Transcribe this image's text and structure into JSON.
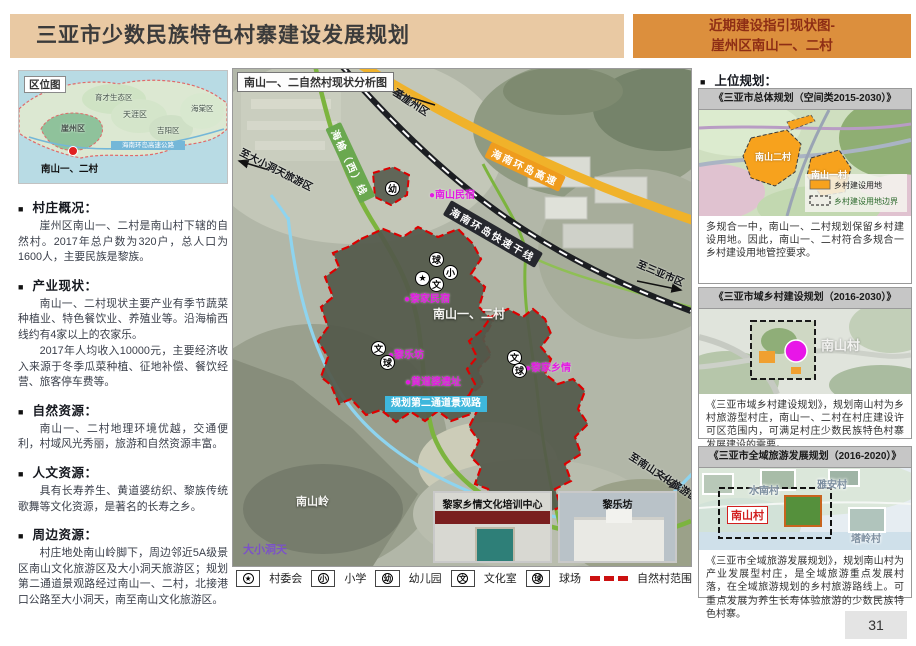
{
  "bullet": "■",
  "header": {
    "title": "三亚市少数民族特色村寨建设发展规划",
    "tag_line1": "近期建设指引现状图-",
    "tag_line2": "崖州区南山一、二村"
  },
  "location_map": {
    "label": "区位图",
    "districts": [
      "育才生态区",
      "崖州区",
      "天涯区",
      "吉阳区",
      "海棠区"
    ],
    "highway": "海南环岛高速公路",
    "marker": "南山一、二村"
  },
  "sections": [
    {
      "title": "村庄概况：",
      "paragraphs": [
        "崖州区南山一、二村是南山村下辖的自然村。2017年总户数为320户，总人口为1600人，主要民族是黎族。"
      ]
    },
    {
      "title": "产业现状：",
      "paragraphs": [
        "南山一、二村现状主要产业有季节蔬菜种植业、特色餐饮业、养殖业等。沿海榆西线约有4家以上的农家乐。",
        "2017年人均收入10000元，主要经济收入来源于冬季瓜菜种植、征地补偿、餐饮经营、旅客停车费等。"
      ]
    },
    {
      "title": "自然资源：",
      "paragraphs": [
        "南山一、二村地理环境优越，交通便利，村域风光秀丽，旅游和自然资源丰富。"
      ]
    },
    {
      "title": "人文资源：",
      "paragraphs": [
        "具有长寿养生、黄道婆纺织、黎族传统歌舞等文化资源，是著名的长寿之乡。"
      ]
    },
    {
      "title": "周边资源：",
      "paragraphs": [
        "村庄地处南山岭脚下，周边邻近5A级景区南山文化旅游区及大小洞天旅游区；规划第二通道景观路经过南山一、二村，北接港口公路至大小洞天，南至南山文化旅游区。"
      ]
    }
  ],
  "map": {
    "title": "南山一、二自然村现状分析图",
    "roads": {
      "expressway": "海南环岛高速",
      "trunk": "海南环岛快速干线",
      "provincial": "海榆（西）线",
      "planned": "规划第二通道景观路"
    },
    "directions": [
      "至崖州区",
      "至大小洞天旅游区",
      "至三亚市区",
      "至南山文化旅游区"
    ],
    "pois": [
      "●南山民宿",
      "●黎家民宿",
      "●黎乐坊",
      "●黄道婆遗址",
      "●黎家乡情"
    ],
    "villages": "南山一、二村",
    "mountain": "南山岭",
    "scenic": "大小洞天",
    "photos": [
      {
        "caption": "黎家乡情文化培训中心"
      },
      {
        "caption": "黎乐坊"
      }
    ]
  },
  "legend": {
    "items": [
      {
        "symbol": "★",
        "label": "村委会"
      },
      {
        "symbol": "小",
        "label": "小学"
      },
      {
        "symbol": "幼",
        "label": "幼儿园"
      },
      {
        "symbol": "文",
        "label": "文化室"
      },
      {
        "symbol": "球",
        "label": "球场"
      }
    ],
    "boundary": "自然村范围"
  },
  "upper_plans": {
    "heading": "上位规划：",
    "boxes": [
      {
        "title": "《三亚市总体规划（空间类2015-2030）》",
        "labels": [
          "南山二村",
          "南山一村"
        ],
        "legend": [
          "乡村建设用地",
          "乡村建设用地边界"
        ],
        "text": "多规合一中，南山一、二村规划保留乡村建设用地。因此，南山一、二村符合多规合一乡村建设用地管控要求。"
      },
      {
        "title": "《三亚市域乡村建设规划（2016-2030）》",
        "labels": [
          "南山村"
        ],
        "text": "《三亚市域乡村建设规划》，规划南山村为乡村旅游型村庄，南山一、二村在村庄建设许可区范围内，可满足村庄少数民族特色村寨发展建设的需要。"
      },
      {
        "title": "《三亚市全域旅游发展规划（2016-2020）》",
        "labels": [
          "水南村",
          "雅安村",
          "南山村",
          "塔岭村"
        ],
        "text": "《三亚市全域旅游发展规划》，规划南山村为产业发展型村庄，是全域旅游重点发展村落，在全域旅游规划的乡村旅游路线上。可重点发展为养生长寿体验旅游的少数民族特色村寨。"
      }
    ]
  },
  "page_number": "31"
}
